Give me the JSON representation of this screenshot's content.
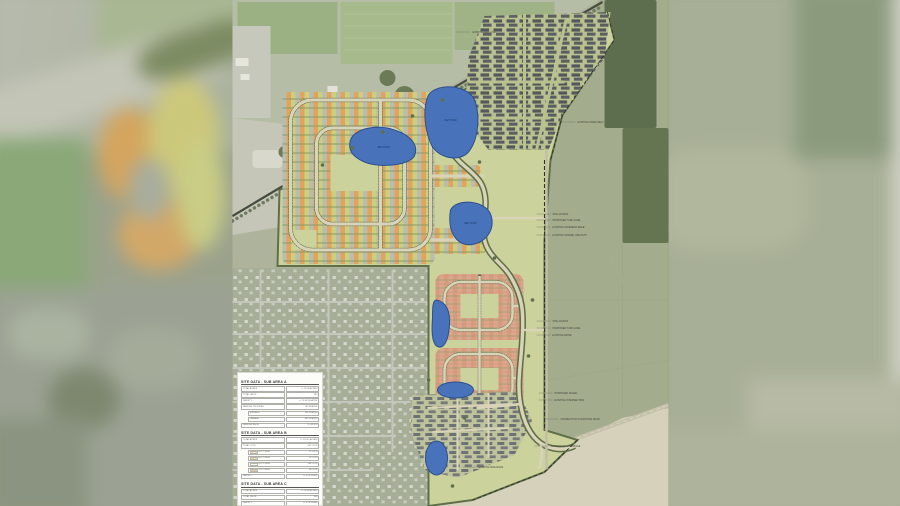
{
  "colors": {
    "pond_fill": "#4873ba",
    "pond_stroke": "#2b4f8e",
    "openspace": "#ccd29b",
    "tree": "#5f7049",
    "lot_orange": "#e2a45c",
    "lot_green": "#cbd07e",
    "lot_gray": "#b8bdae",
    "lot_salmon": "#dca68c",
    "townhome": "#53585c",
    "street": "#d9d3b8",
    "farmland": "#a3ac8c",
    "woods": "#5d6e4f",
    "dirt": "#d5d1bb",
    "swatch_50": "#f5e2b8",
    "swatch_60": "#f0d6a2",
    "swatch_65": "#ffffff",
    "swatch_70": "#edd09b"
  },
  "ponds": [
    {
      "label": "WET POND"
    },
    {
      "label": "WET POND"
    },
    {
      "label": "WET POND"
    }
  ],
  "annotations": [
    {
      "x": 240,
      "y": 33,
      "text": "EXISTING RAIL LINE"
    },
    {
      "x": 345,
      "y": 123,
      "text": "EXISTING FARM FIELD"
    },
    {
      "x": 320,
      "y": 215,
      "text": "SITE ACCESS"
    },
    {
      "x": 320,
      "y": 221,
      "text": "PROPOSED TURN LANE"
    },
    {
      "x": 320,
      "y": 228,
      "text": "EXISTING PAVEMENT EDGE"
    },
    {
      "x": 320,
      "y": 236,
      "text": "EXISTING SHARED USE PATH"
    },
    {
      "x": 320,
      "y": 322,
      "text": "SITE ACCESS"
    },
    {
      "x": 320,
      "y": 329,
      "text": "PROPOSED TURN LANE"
    },
    {
      "x": 320,
      "y": 336,
      "text": "EXISTING DRIVE"
    },
    {
      "x": 322,
      "y": 394,
      "text": "PROPOSED SIGNAL"
    },
    {
      "x": 322,
      "y": 401,
      "text": "EXISTING INTERSECTION"
    },
    {
      "x": 328,
      "y": 420,
      "text": "CONNECTION TO EXISTING ROAD"
    },
    {
      "x": 318,
      "y": 447,
      "text": "COMMERCIAL FRONTAGE"
    },
    {
      "x": 246,
      "y": 468,
      "text": "EXISTING BUILDINGS"
    }
  ],
  "tables": [
    {
      "title": "SITE DATA - SUB AREA A",
      "rows": [
        {
          "label": "TOTAL ACRES",
          "value": "+/- 30.08 ACRES"
        },
        {
          "label": "TOTAL UNITS",
          "value": "380"
        },
        {
          "label": "DENSITY",
          "value": "+/- 12.63 DU/ACRE"
        },
        {
          "label": "PARKING PROVIDED",
          "value": "760 SPACES"
        },
        {
          "label": "SURFACE",
          "value": "398 SPACES",
          "indent": true
        },
        {
          "label": "GARAGE",
          "value": "362 SPACES",
          "indent": true
        },
        {
          "label": "PARKING RATIO",
          "value": "2.0 SP/DU"
        }
      ]
    },
    {
      "title": "SITE DATA - SUB AREA B",
      "rows": [
        {
          "label": "TOTAL ACRES",
          "value": "+/- 120.41 ACRES"
        },
        {
          "label": "TOTAL LOTS",
          "value": "307 LOTS"
        },
        {
          "label": "50 FT WIDE",
          "value": "71 LOTS",
          "indent": true,
          "swatch": "#f5e2b8"
        },
        {
          "label": "60 FT WIDE",
          "value": "74 LOTS",
          "indent": true,
          "swatch": "#f0d6a2"
        },
        {
          "label": "65 FT WIDE",
          "value": "104 LOTS",
          "indent": true,
          "swatch": "#ffffff"
        },
        {
          "label": "70 FT WIDE",
          "value": "58 LOTS",
          "indent": true,
          "swatch": "#edd09b"
        },
        {
          "label": "DENSITY",
          "value": "+/- 2.55 DU/AC"
        }
      ]
    },
    {
      "title": "SITE DATA - SUB AREA C",
      "rows": [
        {
          "label": "TOTAL ACRES",
          "value": "+/- 30.68 ACRES"
        },
        {
          "label": "TOTAL UNITS",
          "value": "300"
        },
        {
          "label": "DENSITY",
          "value": "+/- 9.78 DU/AC"
        }
      ]
    }
  ]
}
